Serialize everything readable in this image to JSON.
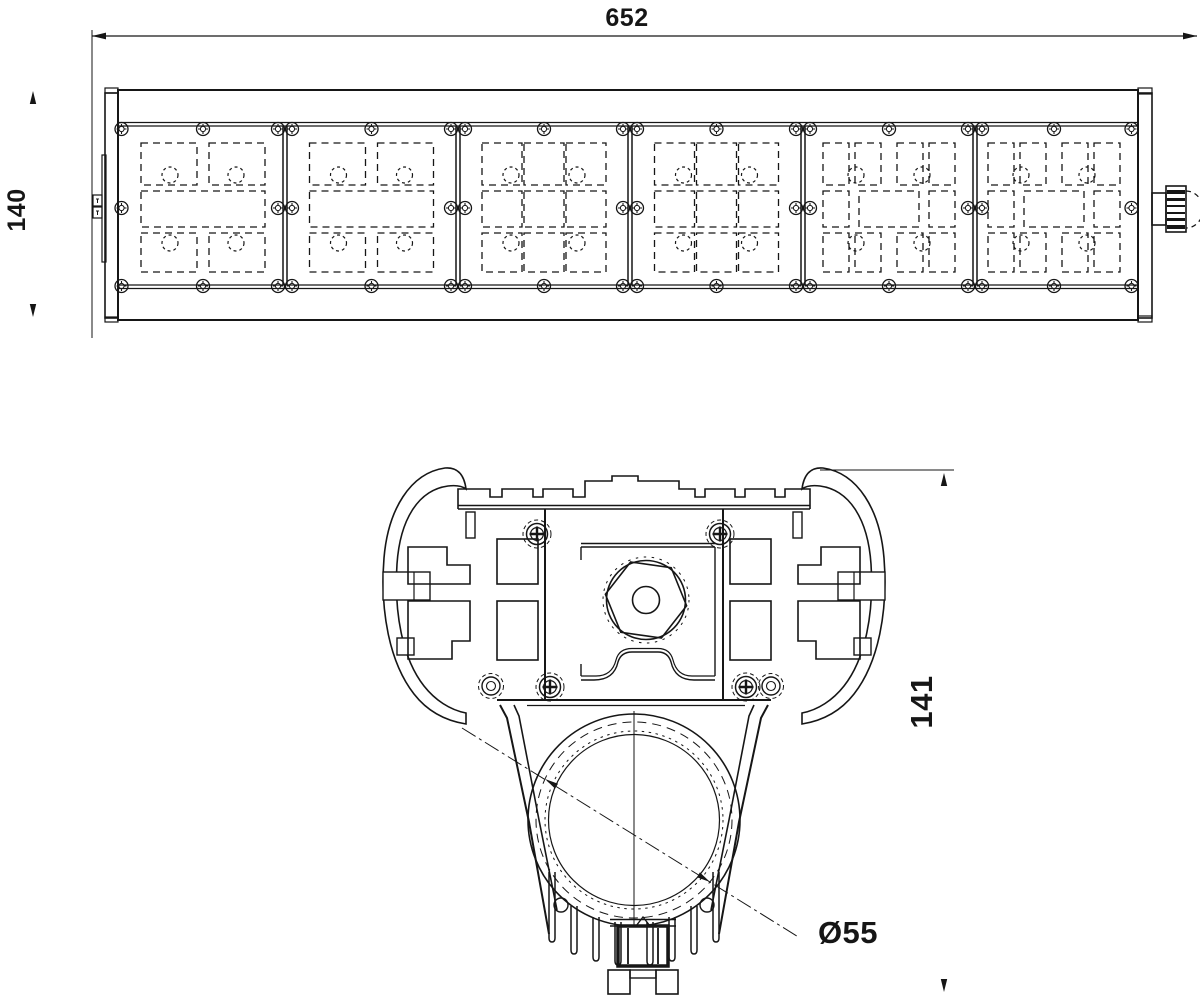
{
  "drawing": {
    "type": "technical-dimension-drawing",
    "colors": {
      "background": "#ffffff",
      "line": "#161616"
    },
    "top_view": {
      "name": "fixture top view",
      "length_dim": "652",
      "height_dim": "140",
      "module_count": 6,
      "module_patterns": [
        "A",
        "A",
        "B",
        "B",
        "C",
        "C"
      ],
      "separators_x": [
        285,
        458,
        630,
        803,
        975
      ],
      "module_centers_x": [
        203,
        371.5,
        544,
        716.5,
        889,
        1054
      ],
      "screw_rows_y": [
        129,
        208,
        286
      ],
      "frame_edge_screws_x": [
        121.5,
        1131.5
      ]
    },
    "section_view": {
      "name": "fixture cross section",
      "height_dim": "141",
      "lens_diameter_dim": "Ø55",
      "lens_center": {
        "x": 634,
        "y": 820
      },
      "lens_radii": [
        106,
        98,
        89,
        85.5
      ],
      "fins_left": [
        {
          "x": 549,
          "top": 872,
          "bottom": 938
        },
        {
          "x": 571,
          "top": 906,
          "bottom": 950
        },
        {
          "x": 593,
          "top": 917,
          "bottom": 957
        },
        {
          "x": 615,
          "top": 922,
          "bottom": 961
        }
      ],
      "screws_phillips": [
        {
          "x": 537,
          "y": 534
        },
        {
          "x": 720,
          "y": 534
        },
        {
          "x": 550,
          "y": 687
        },
        {
          "x": 746,
          "y": 687
        }
      ],
      "screws_plain": [
        {
          "x": 491,
          "y": 686
        },
        {
          "x": 771,
          "y": 686
        }
      ]
    }
  }
}
